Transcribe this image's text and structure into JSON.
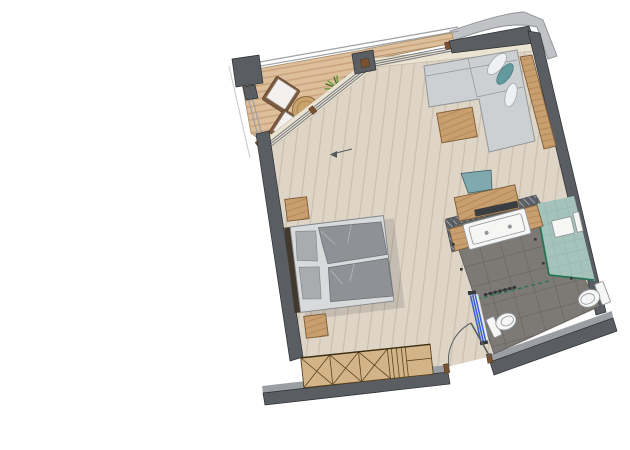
{
  "scene": {
    "type": "floor-plan",
    "view": "top-down"
  },
  "colors": {
    "wall": "#5a5e63",
    "wall_edge": "#2b2e31",
    "wall_light": "#9b9ea2",
    "awning": "#c0c2c5",
    "awning_edge": "#8e9194",
    "railing": "#9da0a4",
    "window_frame": "#ebe3d2",
    "glass_line": "#75787c",
    "deck": "#ddbf9c",
    "deck_stripe": "#c49e74",
    "deck_edge": "#a88c66",
    "floor": "#ded5c7",
    "floor_line": "#c4b7a2",
    "wood": "#c99f6f",
    "wood_stripe": "#ad8354",
    "wood_edge": "#7c5c38",
    "wood_dark": "#7a5230",
    "wardrobe": "#d3b488",
    "wardrobe_line": "#5a431f",
    "headboard": "#42392e",
    "bed_frame": "#d8dadc",
    "bed_edge": "#82868a",
    "duvet": "#8e9195",
    "duvet_fold": "#b6b9bc",
    "pillow": "#a9acaf",
    "sofa": "#cdd0d2",
    "sofa_line": "#94979b",
    "pillow_teal": "#64999d",
    "chair_teal": "#7fa9ae",
    "chair_frame": "#7b5a40",
    "bath_floor": "#7d7974",
    "bath_grout": "#68645f",
    "shower_tile": "#a6c3bb",
    "shower_line": "#8fb2a9",
    "glass_green": "#257455",
    "fixture": "#f6f6f4",
    "fixture_line": "#8f959a",
    "door_blue": "#3560d6",
    "plant": "#6f9c42",
    "plant_dark": "#3f6b24",
    "table_wood": "#c9a369"
  },
  "rooms": [
    {
      "name": "balcony",
      "floor": "wood decking"
    },
    {
      "name": "living-sleeping-area",
      "floor": "light wood planks"
    },
    {
      "name": "bathroom",
      "floor": "anthracite tile"
    },
    {
      "name": "walk-in-shower",
      "floor": "teal tile"
    }
  ],
  "furniture": [
    {
      "name": "lounge-chair",
      "room": "balcony",
      "count": 2
    },
    {
      "name": "round-side-table",
      "room": "balcony",
      "count": 1
    },
    {
      "name": "potted-plant",
      "room": "balcony",
      "count": 1
    },
    {
      "name": "sliding-glass-door",
      "room": "balcony",
      "count": 1
    },
    {
      "name": "double-bed",
      "room": "living-sleeping-area",
      "count": 1
    },
    {
      "name": "nightstand",
      "room": "living-sleeping-area",
      "count": 2
    },
    {
      "name": "wardrobe",
      "room": "living-sleeping-area",
      "count": 1
    },
    {
      "name": "l-shaped-sofa",
      "room": "living-sleeping-area",
      "count": 1
    },
    {
      "name": "decorative-cushion",
      "room": "living-sleeping-area",
      "count": 3
    },
    {
      "name": "coffee-table",
      "room": "living-sleeping-area",
      "count": 1
    },
    {
      "name": "wall-console",
      "room": "living-sleeping-area",
      "count": 1
    },
    {
      "name": "desk",
      "room": "living-sleeping-area",
      "count": 1
    },
    {
      "name": "desk-chair",
      "room": "living-sleeping-area",
      "count": 1
    },
    {
      "name": "laptop",
      "room": "living-sleeping-area",
      "count": 1
    },
    {
      "name": "entry-door",
      "room": "living-sleeping-area",
      "count": 1
    },
    {
      "name": "vanity-double-washbasin",
      "room": "bathroom",
      "count": 1
    },
    {
      "name": "towel-radiator",
      "room": "bathroom",
      "count": 1
    },
    {
      "name": "shower-stool",
      "room": "walk-in-shower",
      "count": 1
    },
    {
      "name": "shower-wall-panel",
      "room": "walk-in-shower",
      "count": 1
    },
    {
      "name": "toilet",
      "room": "bathroom",
      "count": 1
    },
    {
      "name": "bidet",
      "room": "bathroom",
      "count": 1
    },
    {
      "name": "sliding-door-blue",
      "room": "bathroom",
      "count": 1
    },
    {
      "name": "glass-partition",
      "room": "bathroom",
      "count": 1
    }
  ]
}
